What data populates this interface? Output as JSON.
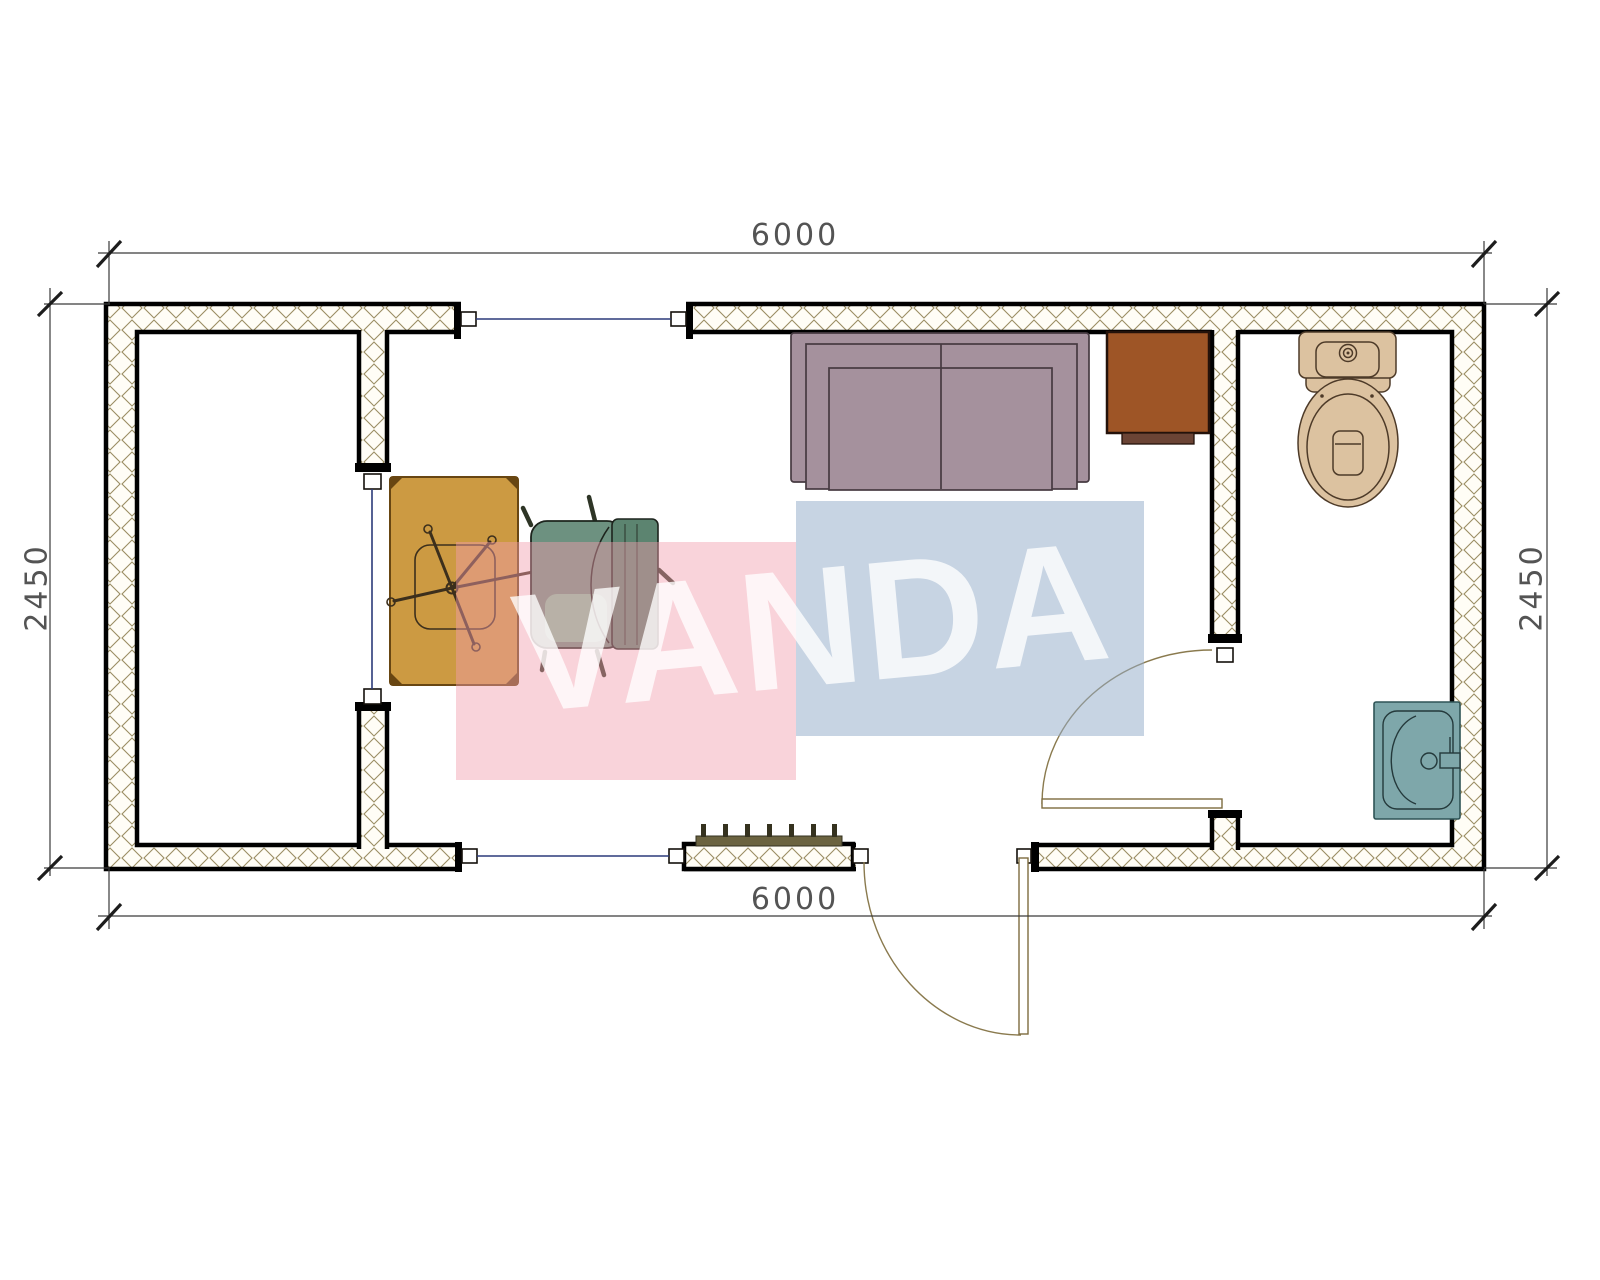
{
  "watermark": {
    "text": "VANDA",
    "pink_color": "rgba(242,158,172,0.45)",
    "blue_color": "rgba(148,172,202,0.52)",
    "text_color": "#ffffff"
  },
  "dimensions": {
    "top": "6000",
    "bottom": "6000",
    "left": "2450",
    "right": "2450"
  },
  "plan": {
    "type": "container-office-floor-plan",
    "wall_outline_color": "#000000",
    "wall_hatch_color": "#9b8d63",
    "window_line_color": "#2b3a7a",
    "door_swing_color": "#8a7a4e",
    "dimension_line_color": "#3a3a3a",
    "furniture": [
      {
        "name": "sofa",
        "color": "#a5919d"
      },
      {
        "name": "cabinet",
        "color": "#9e5526"
      },
      {
        "name": "toilet",
        "color": "#dcc2a0"
      },
      {
        "name": "sink",
        "color": "#7ea7aa"
      },
      {
        "name": "desk",
        "color": "#cc9a42"
      },
      {
        "name": "office-chair",
        "color": "#6d9180"
      },
      {
        "name": "task-chair-base",
        "color": "#3c2f1c"
      },
      {
        "name": "radiator",
        "color": "#6b6340"
      }
    ]
  }
}
